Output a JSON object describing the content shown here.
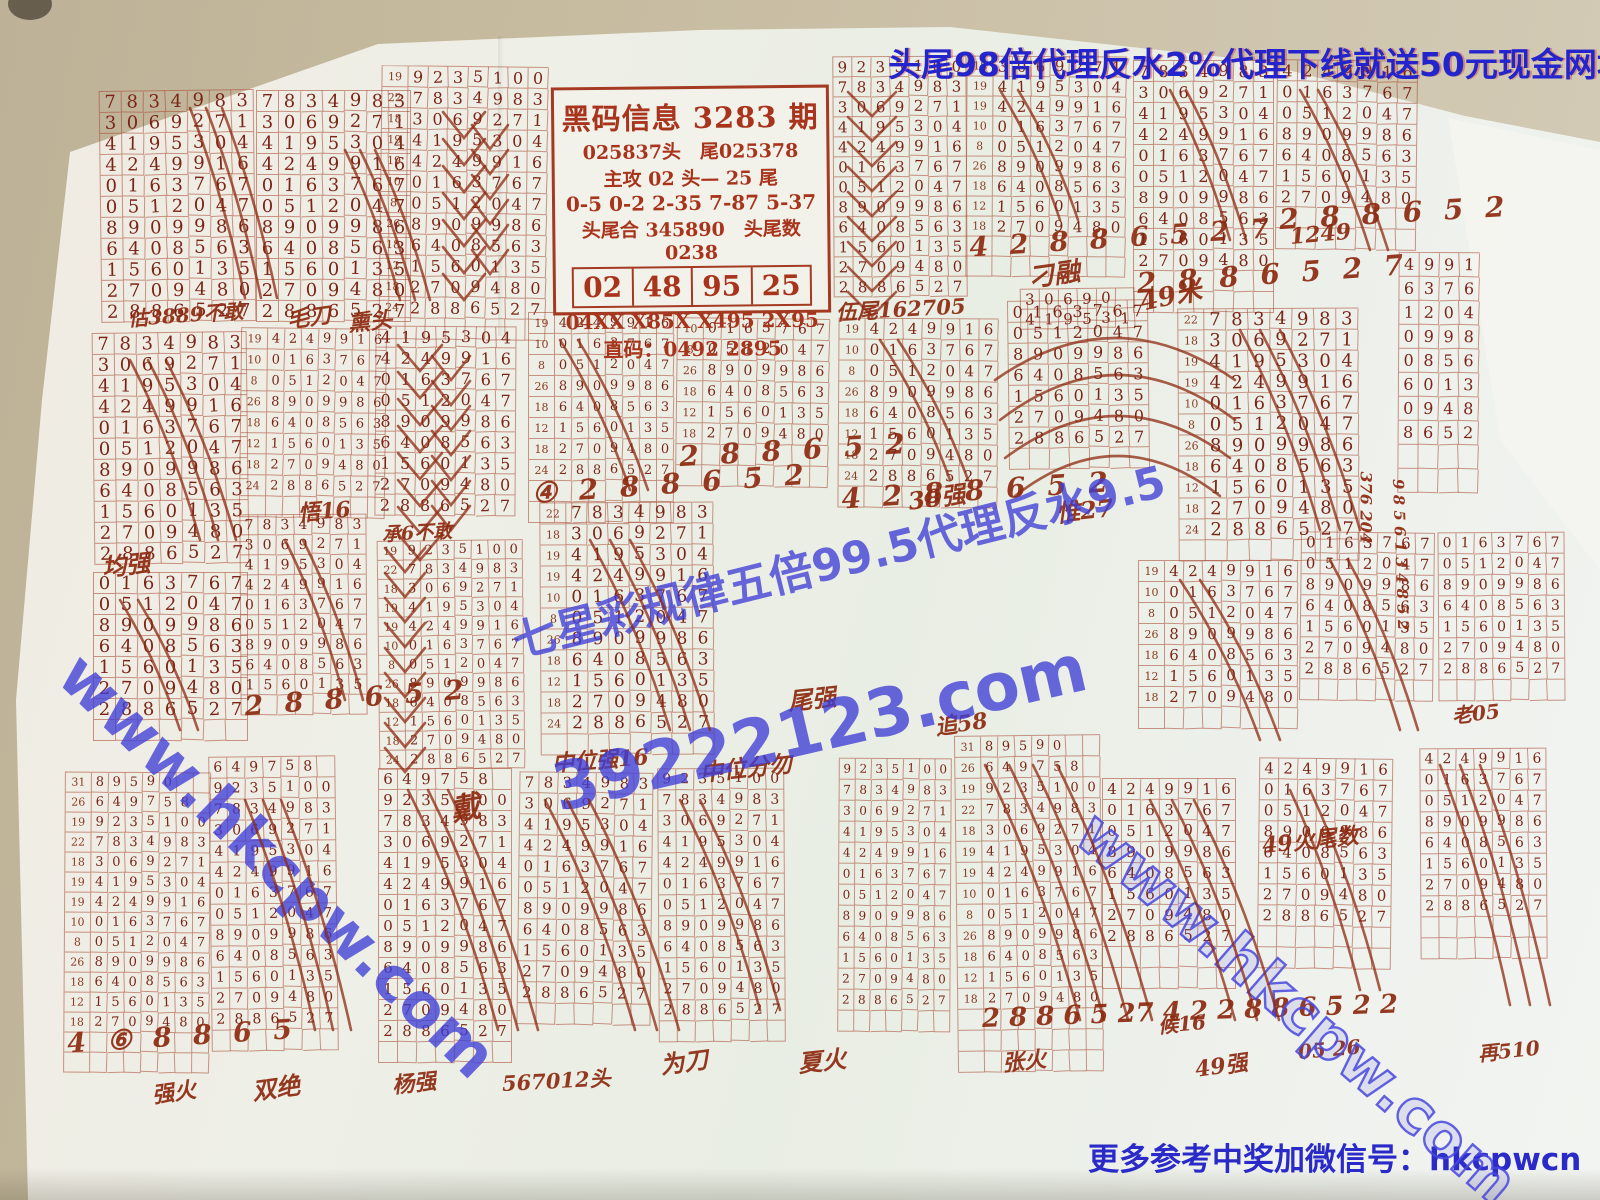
{
  "promo_top": "头尾98倍代理反水2%代理下线就送50元现金网址66373.com",
  "contact_bottom": "更多参考中奖加微信号：hkcpwcn",
  "info_box": {
    "title": "黑码信息 3283 期",
    "line1": "025837头　尾025378",
    "line2": "主攻 02 头— 25 尾",
    "line3": "0-5  0-2  2-35  7-87  5-37",
    "line4": "头尾合 345890　头尾数 0238",
    "cells": [
      "02",
      "48",
      "95",
      "25"
    ],
    "line5": "04XX  X85X  X495  2X95",
    "line6": "直码：0492  2895"
  },
  "watermarks": {
    "hk_left": {
      "text": "www.hkcpw.com",
      "x": 95,
      "y": 638,
      "rot": 44,
      "size": 62
    },
    "hk_right": {
      "text": "www.hkcpw.com",
      "x": 1108,
      "y": 798,
      "rot": 41,
      "size": 60
    },
    "agent": {
      "text": "七星彩规律五倍99.5代理反水9.5",
      "x": 505,
      "y": 608,
      "rot": -14,
      "size": 44
    },
    "site": {
      "text": "39222123.com",
      "x": 545,
      "y": 752,
      "rot": -13,
      "size": 66
    }
  },
  "colors": {
    "desk": "#c6bb9f",
    "paper": "#edefe7",
    "grid_line": "#a5462d",
    "digit_red": "#7c2517",
    "hand_red": "#8d2a10",
    "blue": "#2424cd"
  },
  "sequence": [
    {
      "l": "31",
      "d": "89590"
    },
    {
      "l": "26",
      "d": "649758"
    },
    {
      "l": "19",
      "d": "9235100"
    },
    {
      "l": "22",
      "d": "7834983"
    },
    {
      "l": "18",
      "d": "3069271"
    },
    {
      "l": "19",
      "d": "4195304"
    },
    {
      "l": "19",
      "d": "4249916"
    },
    {
      "l": "10",
      "d": "0163767"
    },
    {
      "l": "8",
      "d": "0512047"
    },
    {
      "l": "26",
      "d": "8909986"
    },
    {
      "l": "18",
      "d": "6408563"
    },
    {
      "l": "12",
      "d": "1560135"
    },
    {
      "l": "18",
      "d": "2709480"
    },
    {
      "l": "24",
      "d": "2886527"
    }
  ],
  "blocks": [
    {
      "x": 100,
      "y": 90,
      "from": 3,
      "to": 13
    },
    {
      "x": 256,
      "y": 90,
      "from": 3,
      "to": 13
    },
    {
      "x": 380,
      "y": 66,
      "from": 2,
      "to": 13,
      "labeled": true,
      "cw": 20,
      "extra": 1
    },
    {
      "x": 833,
      "y": 56,
      "from": 2,
      "to": 13,
      "cw": 19,
      "rh": 20
    },
    {
      "x": 966,
      "y": 56,
      "from": 4,
      "to": 12,
      "labeled": true,
      "cw": 19,
      "rh": 20,
      "hand": "4 2 8 8 6 5 2 7",
      "extra": 2
    },
    {
      "x": 1020,
      "y": 288,
      "rows": [
        "30690",
        "419531"
      ],
      "cw": 19,
      "rh": 20
    },
    {
      "x": 1133,
      "y": 60,
      "from": 3,
      "to": 12,
      "cw": 20,
      "hand": "2 8 8 6 5 2 7",
      "extra": 2
    },
    {
      "x": 1276,
      "y": 60,
      "from": 6,
      "to": 12,
      "cw": 20,
      "hand": "2 8 8 6 5 2",
      "extra": 2
    },
    {
      "x": 1178,
      "y": 308,
      "from": 3,
      "to": 13,
      "labeled": true,
      "extra": 1
    },
    {
      "x": 1398,
      "y": 252,
      "rows": [
        "4991",
        "6376",
        "1204",
        "0998",
        "0856",
        "6013",
        "0948",
        "8652"
      ],
      "cw": 20,
      "rh": 24,
      "extra": 2
    },
    {
      "x": 93,
      "y": 332,
      "from": 3,
      "to": 13
    },
    {
      "x": 93,
      "y": 572,
      "from": 7,
      "to": 13,
      "extra": 1
    },
    {
      "x": 240,
      "y": 328,
      "from": 6,
      "to": 13,
      "labeled": true,
      "cw": 17,
      "extra": 1
    },
    {
      "x": 240,
      "y": 514,
      "from": 3,
      "to": 11,
      "cw": 18,
      "rh": 20,
      "hand": "2 8 8 6 5 2",
      "extra": 1
    },
    {
      "x": 375,
      "y": 326,
      "from": 5,
      "to": 13,
      "cw": 20
    },
    {
      "x": 378,
      "y": 540,
      "from": 2,
      "to": 13,
      "labeled": true,
      "cw": 17,
      "rh": 19
    },
    {
      "x": 528,
      "y": 312,
      "from": 6,
      "to": 13,
      "labeled": true,
      "cw": 17,
      "hand": "④ 2 8 8 6 5 2",
      "extra": 2
    },
    {
      "x": 676,
      "y": 318,
      "from": 7,
      "to": 12,
      "labeled": true,
      "cw": 18,
      "hand": "2 8 8 6 5 2",
      "extra": 2
    },
    {
      "x": 540,
      "y": 502,
      "from": 3,
      "to": 13,
      "labeled": true,
      "cw": 21,
      "extra": 1
    },
    {
      "x": 838,
      "y": 318,
      "from": 6,
      "to": 13,
      "labeled": true,
      "cw": 19,
      "hand": "4 2 8 8 6 5 2",
      "extra": 1
    },
    {
      "x": 1008,
      "y": 300,
      "from": 7,
      "to": 13,
      "cw": 20,
      "extra": 1
    },
    {
      "x": 1138,
      "y": 560,
      "from": 6,
      "to": 12,
      "labeled": true,
      "cw": 19,
      "extra": 1
    },
    {
      "x": 1300,
      "y": 532,
      "from": 7,
      "to": 13,
      "cw": 19,
      "extra": 1
    },
    {
      "x": 1438,
      "y": 532,
      "from": 7,
      "to": 13,
      "cw": 18,
      "extra": 1
    },
    {
      "x": 64,
      "y": 772,
      "from": 0,
      "to": 12,
      "labeled": true,
      "cw": 17,
      "rh": 20,
      "hand": "4 ⑥ 8 8 6 5",
      "extra": 2
    },
    {
      "x": 210,
      "y": 756,
      "from": 1,
      "to": 13,
      "cw": 18,
      "extra": 1
    },
    {
      "x": 378,
      "y": 768,
      "from": 1,
      "to": 13,
      "cw": 19,
      "extra": 1
    },
    {
      "x": 518,
      "y": 772,
      "from": 3,
      "to": 13,
      "cw": 19,
      "extra": 1
    },
    {
      "x": 658,
      "y": 768,
      "from": 2,
      "to": 13,
      "cw": 18,
      "extra": 1
    },
    {
      "x": 838,
      "y": 758,
      "from": 2,
      "to": 13,
      "cw": 16,
      "extra": 1
    },
    {
      "x": 956,
      "y": 735,
      "from": 0,
      "to": 12,
      "labeled": true,
      "cw": 17,
      "extra": 3
    },
    {
      "x": 1102,
      "y": 778,
      "from": 6,
      "to": 13,
      "cw": 19,
      "extra": 2
    },
    {
      "x": 1258,
      "y": 758,
      "from": 6,
      "to": 13,
      "cw": 19,
      "extra": 2
    },
    {
      "x": 1420,
      "y": 748,
      "from": 6,
      "to": 13,
      "cw": 18,
      "extra": 2
    }
  ],
  "annotations": [
    {
      "text": "估3889不敢",
      "x": 128,
      "y": 303,
      "size": 20,
      "rot": -4
    },
    {
      "text": "毛刀",
      "x": 287,
      "y": 303,
      "size": 22,
      "rot": -8
    },
    {
      "text": "熏头",
      "x": 348,
      "y": 306,
      "size": 22,
      "rot": -5
    },
    {
      "text": "伍尾162705",
      "x": 836,
      "y": 297,
      "size": 21,
      "rot": -3
    },
    {
      "text": "刁融",
      "x": 1028,
      "y": 258,
      "size": 26,
      "rot": -8
    },
    {
      "text": "49米",
      "x": 1140,
      "y": 282,
      "size": 26,
      "rot": -12
    },
    {
      "text": "1249",
      "x": 1290,
      "y": 224,
      "size": 22,
      "rot": -5
    },
    {
      "text": "均强",
      "x": 102,
      "y": 548,
      "size": 24,
      "rot": -6
    },
    {
      "text": "悟16",
      "x": 298,
      "y": 496,
      "size": 22,
      "rot": -5
    },
    {
      "text": "承6不敢",
      "x": 382,
      "y": 520,
      "size": 19,
      "rot": -3
    },
    {
      "text": "戴",
      "x": 450,
      "y": 786,
      "size": 30,
      "rot": -10
    },
    {
      "text": "尾强",
      "x": 788,
      "y": 682,
      "size": 24,
      "rot": -6
    },
    {
      "text": "中位强16",
      "x": 552,
      "y": 746,
      "size": 22,
      "rot": -4
    },
    {
      "text": "中位分勿",
      "x": 700,
      "y": 754,
      "size": 23,
      "rot": -6
    },
    {
      "text": "38强",
      "x": 908,
      "y": 482,
      "size": 24,
      "rot": -8
    },
    {
      "text": "惟27",
      "x": 1056,
      "y": 494,
      "size": 24,
      "rot": -6
    },
    {
      "text": "49火尾数",
      "x": 1262,
      "y": 828,
      "size": 22,
      "rot": -6
    },
    {
      "text": "追58",
      "x": 935,
      "y": 710,
      "size": 22,
      "rot": -8
    },
    {
      "text": "老05",
      "x": 1452,
      "y": 700,
      "size": 20,
      "rot": -6
    },
    {
      "text": "强火",
      "x": 152,
      "y": 1078,
      "size": 22,
      "rot": -8
    },
    {
      "text": "双绝",
      "x": 252,
      "y": 1072,
      "size": 24,
      "rot": -8
    },
    {
      "text": "杨强",
      "x": 392,
      "y": 1068,
      "size": 22,
      "rot": -6
    },
    {
      "text": "567012头",
      "x": 502,
      "y": 1068,
      "size": 21,
      "rot": -3
    },
    {
      "text": "为刀",
      "x": 660,
      "y": 1046,
      "size": 24,
      "rot": -8
    },
    {
      "text": "夏火",
      "x": 798,
      "y": 1044,
      "size": 24,
      "rot": -6
    },
    {
      "text": "张火",
      "x": 1002,
      "y": 1046,
      "size": 22,
      "rot": -6
    },
    {
      "text": "候16",
      "x": 1158,
      "y": 1010,
      "size": 20,
      "rot": -5
    },
    {
      "text": "49强",
      "x": 1195,
      "y": 1052,
      "size": 22,
      "rot": -8
    },
    {
      "text": "05 26",
      "x": 1298,
      "y": 1040,
      "size": 20,
      "rot": -5
    },
    {
      "text": "再510",
      "x": 1478,
      "y": 1038,
      "size": 20,
      "rot": -6
    },
    {
      "text": "2 8 8 6 5 27 4 2 2 8 8 6 5 2 2",
      "x": 982,
      "y": 1004,
      "size": 26,
      "rot": -2
    },
    {
      "text": "376 204",
      "x": 1366,
      "y": 462,
      "size": 16,
      "rot": 90
    },
    {
      "text": "9 8 5 6 1 3 4 8 5 2",
      "x": 1398,
      "y": 470,
      "size": 15,
      "rot": 88
    }
  ],
  "strokes": [
    {
      "kind": "slash",
      "x": 190,
      "y": 108,
      "w": 55,
      "h": 190,
      "n": 3,
      "sp": 16
    },
    {
      "kind": "slash",
      "x": 345,
      "y": 150,
      "w": 55,
      "h": 150,
      "n": 3,
      "sp": 15
    },
    {
      "kind": "zigzag",
      "x": 443,
      "y": 112,
      "w": 42,
      "h": 26,
      "n": 7
    },
    {
      "kind": "zigzag",
      "x": 472,
      "y": 125,
      "w": 36,
      "h": 24,
      "n": 6
    },
    {
      "kind": "zigzag",
      "x": 848,
      "y": 92,
      "w": 48,
      "h": 24,
      "n": 9
    },
    {
      "kind": "zigzag",
      "x": 398,
      "y": 345,
      "w": 44,
      "h": 26,
      "n": 8
    },
    {
      "kind": "zigzag",
      "x": 432,
      "y": 356,
      "w": 38,
      "h": 24,
      "n": 7
    },
    {
      "kind": "zigzag",
      "x": 385,
      "y": 548,
      "w": 40,
      "h": 24,
      "n": 9
    },
    {
      "kind": "arc",
      "x": 995,
      "y": 380,
      "w": 240,
      "h": 42
    },
    {
      "kind": "arc",
      "x": 1000,
      "y": 420,
      "w": 235,
      "h": 45
    },
    {
      "kind": "arc",
      "x": 1005,
      "y": 458,
      "w": 225,
      "h": 42
    },
    {
      "kind": "arc",
      "x": 1015,
      "y": 496,
      "w": 205,
      "h": 40
    },
    {
      "kind": "slash",
      "x": 985,
      "y": 765,
      "w": 95,
      "h": 255,
      "n": 4,
      "sp": 24
    },
    {
      "kind": "slash",
      "x": 1150,
      "y": 800,
      "w": 85,
      "h": 220,
      "n": 3,
      "sp": 22
    },
    {
      "kind": "slash",
      "x": 1440,
      "y": 765,
      "w": 70,
      "h": 240,
      "n": 3,
      "sp": 20
    },
    {
      "kind": "slash",
      "x": 408,
      "y": 790,
      "w": 90,
      "h": 240,
      "n": 3,
      "sp": 20
    },
    {
      "kind": "slash",
      "x": 545,
      "y": 800,
      "w": 90,
      "h": 230,
      "n": 3,
      "sp": 22
    },
    {
      "kind": "slash",
      "x": 680,
      "y": 800,
      "w": 80,
      "h": 210,
      "n": 2,
      "sp": 20
    },
    {
      "kind": "slash",
      "x": 245,
      "y": 800,
      "w": 70,
      "h": 230,
      "n": 3,
      "sp": 18
    },
    {
      "kind": "slash",
      "x": 120,
      "y": 600,
      "w": 60,
      "h": 130,
      "n": 2,
      "sp": 18
    },
    {
      "kind": "slash",
      "x": 130,
      "y": 360,
      "w": 70,
      "h": 180,
      "n": 3,
      "sp": 18
    },
    {
      "kind": "slash",
      "x": 285,
      "y": 540,
      "w": 60,
      "h": 160,
      "n": 2,
      "sp": 18
    },
    {
      "kind": "slash",
      "x": 590,
      "y": 540,
      "w": 80,
      "h": 190,
      "n": 3,
      "sp": 20
    },
    {
      "kind": "slash",
      "x": 560,
      "y": 340,
      "w": 70,
      "h": 150,
      "n": 2,
      "sp": 18
    },
    {
      "kind": "slash",
      "x": 880,
      "y": 340,
      "w": 70,
      "h": 140,
      "n": 2,
      "sp": 18
    },
    {
      "kind": "slash",
      "x": 1240,
      "y": 330,
      "w": 80,
      "h": 200,
      "n": 3,
      "sp": 20
    },
    {
      "kind": "slash",
      "x": 1180,
      "y": 580,
      "w": 80,
      "h": 160,
      "n": 2,
      "sp": 20
    },
    {
      "kind": "slash",
      "x": 1330,
      "y": 560,
      "w": 70,
      "h": 170,
      "n": 2,
      "sp": 18
    },
    {
      "kind": "slash",
      "x": 1300,
      "y": 90,
      "w": 70,
      "h": 160,
      "n": 2,
      "sp": 18
    },
    {
      "kind": "slash",
      "x": 1170,
      "y": 90,
      "w": 60,
      "h": 150,
      "n": 2,
      "sp": 16
    },
    {
      "kind": "slash",
      "x": 1000,
      "y": 90,
      "w": 60,
      "h": 130,
      "n": 2,
      "sp": 18
    },
    {
      "kind": "slash",
      "x": 1290,
      "y": 790,
      "w": 70,
      "h": 200,
      "n": 2,
      "sp": 20
    }
  ]
}
